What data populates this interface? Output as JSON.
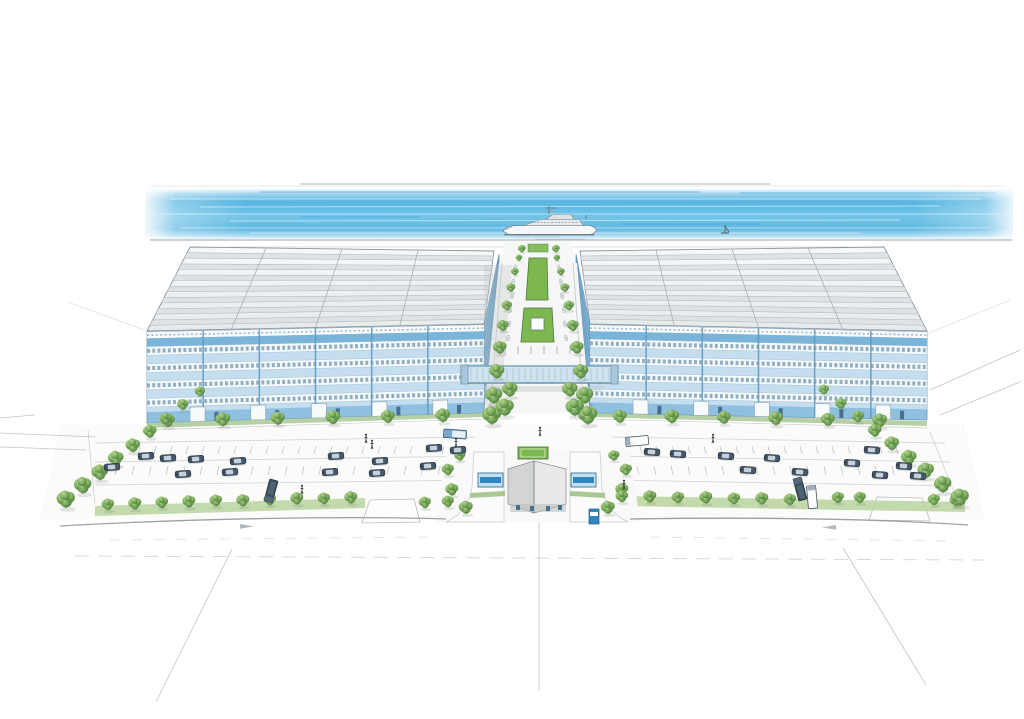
{
  "scene": {
    "type": "architectural-watercolor-rendering",
    "description": "Hand-drawn aerial perspective rendering of a waterfront business park: two large blue-glass warehouse buildings with skylight roofs flank a central tree-lined boulevard with green median, linked by a glazed pedestrian bridge; a gatehouse entrance, landscaped parking lots with cars and trucks, perimeter tree rows, a quay with a superyacht and a small sailboat on the water behind, and faint pencil perspective lines in the foreground",
    "objects": [
      "water-band",
      "yacht",
      "sailboat",
      "left-warehouse",
      "right-warehouse",
      "roof-skylights",
      "facade-window-bands",
      "central-boulevard",
      "median-lawn",
      "pedestrian-bridge",
      "gatehouse",
      "gate-canopies",
      "parking-lot-left",
      "parking-lot-right",
      "cars",
      "trucks",
      "perimeter-trees",
      "front-road",
      "sketch-lines",
      "pedestrians"
    ]
  },
  "colors": {
    "paper": "#ffffff",
    "water_deep": "#4fb2e0",
    "water_mid": "#74c4e7",
    "water_pale": "#c9e8f5",
    "facade_blue": "#8fc0e0",
    "facade_dark": "#5e99c4",
    "facade_deep": "#79b2d8",
    "spandrel": "#cfe3f1",
    "window_white": "#f7fbfd",
    "window_tick": "#517f9d",
    "inner_wall": "#7fb0d2",
    "roof_light": "#eff1f2",
    "roof_strip": "#dde2e5",
    "roof_line": "#a7b0b5",
    "tree_dark": "#4a7c3c",
    "lawn": "#7db74f",
    "hedge_band": "#b9d49f",
    "verge": "#aecb9b",
    "paving": "#f5f6f5",
    "paving_line": "#c2c8cb",
    "car_body": "#46586a",
    "car_glass": "#cdd8df",
    "gate_roof_l": "#d2d5d2",
    "gate_roof_r": "#e9eae7",
    "bridge_glass": "#cfe2ee",
    "bridge_frame": "#7aa3c0",
    "pencil": "#aab1b5",
    "accent_blue": "#2f86c0",
    "outline_gray": "#8d969c"
  },
  "layout": {
    "roof_left": {
      "bl": [
        147,
        331
      ],
      "tl": [
        190,
        247
      ],
      "tr": [
        494,
        251
      ],
      "br": [
        484,
        324
      ],
      "rows": 7
    },
    "roof_right": {
      "bl": [
        590,
        324
      ],
      "tl": [
        580,
        251
      ],
      "tr": [
        884,
        247
      ],
      "br": [
        927,
        331
      ],
      "rows": 7
    },
    "facade_left": {
      "tl": [
        147,
        332
      ],
      "tr": [
        484,
        325
      ],
      "br": [
        484,
        413
      ],
      "bl": [
        147,
        423
      ],
      "bays": 6,
      "bands": [
        0.16,
        0.35,
        0.54,
        0.73
      ],
      "band_h": 0.095,
      "doors": [
        0.15,
        0.33,
        0.51,
        0.69,
        0.87
      ]
    },
    "facade_right": {
      "tl": [
        590,
        325
      ],
      "tr": [
        927,
        332
      ],
      "br": [
        927,
        420
      ],
      "bl": [
        590,
        413
      ],
      "bays": 6,
      "bands": [
        0.16,
        0.35,
        0.54,
        0.73
      ],
      "band_h": 0.095,
      "doors": [
        0.15,
        0.33,
        0.51,
        0.69,
        0.87
      ]
    },
    "trees": {
      "quay": [
        [
          522,
          249,
          0.45
        ],
        [
          556,
          249,
          0.45
        ]
      ],
      "facade_left": [
        [
          168,
          421,
          0.8
        ],
        [
          223,
          420,
          0.85
        ],
        [
          278,
          419,
          0.8
        ],
        [
          333,
          418,
          0.85
        ],
        [
          388,
          417,
          0.8
        ],
        [
          443,
          416,
          0.85
        ]
      ],
      "facade_right": [
        [
          620,
          417,
          0.8
        ],
        [
          672,
          417,
          0.85
        ],
        [
          724,
          418,
          0.8
        ],
        [
          776,
          419,
          0.85
        ],
        [
          828,
          420,
          0.8
        ],
        [
          880,
          421,
          0.85
        ]
      ],
      "boulevard_left": [
        [
          519,
          258,
          0.38
        ],
        [
          515,
          272,
          0.45
        ],
        [
          511,
          288,
          0.52
        ],
        [
          507,
          306,
          0.6
        ],
        [
          503,
          326,
          0.68
        ],
        [
          500,
          348,
          0.78
        ],
        [
          497,
          372,
          0.88
        ],
        [
          494,
          396,
          1.0
        ],
        [
          492,
          416,
          1.1
        ]
      ],
      "boulevard_right": [
        [
          557,
          258,
          0.38
        ],
        [
          561,
          272,
          0.45
        ],
        [
          565,
          288,
          0.52
        ],
        [
          569,
          306,
          0.6
        ],
        [
          573,
          326,
          0.68
        ],
        [
          577,
          348,
          0.78
        ],
        [
          581,
          372,
          0.88
        ],
        [
          585,
          396,
          1.0
        ],
        [
          588,
          416,
          1.1
        ]
      ],
      "median_clusters": [
        [
          505,
          408,
          1.05
        ],
        [
          575,
          408,
          1.05
        ],
        [
          510,
          390,
          0.9
        ],
        [
          570,
          390,
          0.9
        ]
      ],
      "gate_left": [
        [
          460,
          456,
          0.65
        ],
        [
          448,
          470,
          0.7
        ],
        [
          452,
          490,
          0.75
        ],
        [
          466,
          508,
          0.8
        ]
      ],
      "gate_right": [
        [
          614,
          456,
          0.65
        ],
        [
          626,
          470,
          0.7
        ],
        [
          622,
          490,
          0.75
        ],
        [
          608,
          508,
          0.8
        ]
      ],
      "front_left": [
        [
          108,
          505,
          0.72
        ],
        [
          135,
          504,
          0.75
        ],
        [
          162,
          503,
          0.72
        ],
        [
          189,
          502,
          0.75
        ],
        [
          216,
          501,
          0.72
        ],
        [
          243,
          501,
          0.75
        ],
        [
          270,
          500,
          0.72
        ],
        [
          297,
          499,
          0.75
        ],
        [
          324,
          499,
          0.72
        ],
        [
          351,
          498,
          0.75
        ],
        [
          425,
          503,
          0.7
        ],
        [
          448,
          502,
          0.7
        ]
      ],
      "front_right": [
        [
          622,
          497,
          0.72
        ],
        [
          650,
          497,
          0.75
        ],
        [
          678,
          498,
          0.72
        ],
        [
          706,
          498,
          0.75
        ],
        [
          734,
          499,
          0.72
        ],
        [
          762,
          499,
          0.75
        ],
        [
          790,
          500,
          0.72
        ],
        [
          838,
          498,
          0.7
        ],
        [
          860,
          498,
          0.7
        ],
        [
          934,
          500,
          0.7
        ],
        [
          956,
          501,
          0.72
        ]
      ],
      "diag_left": [
        [
          200,
          392,
          0.6
        ],
        [
          183,
          405,
          0.66
        ],
        [
          166,
          419,
          0.72
        ],
        [
          150,
          432,
          0.78
        ],
        [
          133,
          446,
          0.84
        ],
        [
          116,
          459,
          0.9
        ],
        [
          100,
          473,
          0.95
        ],
        [
          83,
          486,
          1.0
        ],
        [
          66,
          500,
          1.05
        ]
      ],
      "diag_right": [
        [
          824,
          390,
          0.6
        ],
        [
          841,
          404,
          0.66
        ],
        [
          858,
          417,
          0.72
        ],
        [
          875,
          431,
          0.78
        ],
        [
          892,
          444,
          0.84
        ],
        [
          909,
          458,
          0.9
        ],
        [
          926,
          471,
          0.95
        ],
        [
          943,
          485,
          1.0
        ],
        [
          960,
          498,
          1.05
        ]
      ]
    },
    "cars": {
      "left_lot": [
        [
          146,
          456
        ],
        [
          168,
          458
        ],
        [
          112,
          467
        ],
        [
          196,
          459
        ],
        [
          238,
          461
        ],
        [
          230,
          472
        ],
        [
          183,
          474
        ],
        [
          336,
          456
        ],
        [
          380,
          461
        ],
        [
          330,
          472
        ],
        [
          377,
          473
        ],
        [
          428,
          466
        ],
        [
          434,
          448
        ],
        [
          458,
          450
        ]
      ],
      "right_lot": [
        [
          652,
          452
        ],
        [
          678,
          454
        ],
        [
          726,
          456
        ],
        [
          748,
          470
        ],
        [
          772,
          458
        ],
        [
          800,
          472
        ],
        [
          852,
          463
        ],
        [
          880,
          475
        ],
        [
          904,
          466
        ],
        [
          918,
          476
        ],
        [
          872,
          450
        ]
      ]
    },
    "mini_cars": {
      "left": [
        [
          515,
          268
        ],
        [
          513,
          282
        ],
        [
          512,
          296
        ],
        [
          510,
          310
        ],
        [
          509,
          324
        ],
        [
          508,
          338
        ]
      ],
      "right": [
        [
          559,
          268
        ],
        [
          561,
          282
        ],
        [
          562,
          296
        ],
        [
          564,
          310
        ],
        [
          565,
          324
        ],
        [
          566,
          338
        ]
      ]
    },
    "trucks": [
      {
        "x": 271,
        "y": 491,
        "rot": -75,
        "kind": "dark"
      },
      {
        "x": 800,
        "y": 489,
        "rot": 75,
        "kind": "dark"
      },
      {
        "x": 637,
        "y": 441,
        "rot": -5,
        "kind": "white"
      },
      {
        "x": 455,
        "y": 434,
        "rot": 4,
        "kind": "blue"
      },
      {
        "x": 812,
        "y": 497,
        "rot": 85,
        "kind": "white"
      }
    ],
    "people": [
      [
        366,
        438
      ],
      [
        372,
        444
      ],
      [
        456,
        442
      ],
      [
        540,
        431
      ],
      [
        624,
        484
      ],
      [
        713,
        438
      ],
      [
        302,
        489
      ]
    ],
    "stall_rows": [
      {
        "x0": 140,
        "x1": 470,
        "y": 446,
        "step": 16,
        "dx": -2,
        "dy": 8
      },
      {
        "x0": 100,
        "x1": 470,
        "y": 466,
        "step": 17,
        "dx": -2,
        "dy": 9
      },
      {
        "x0": 640,
        "x1": 900,
        "y": 446,
        "step": 16,
        "dx": 2,
        "dy": 8
      },
      {
        "x0": 620,
        "x1": 935,
        "y": 466,
        "step": 17,
        "dx": 2,
        "dy": 9
      }
    ]
  }
}
